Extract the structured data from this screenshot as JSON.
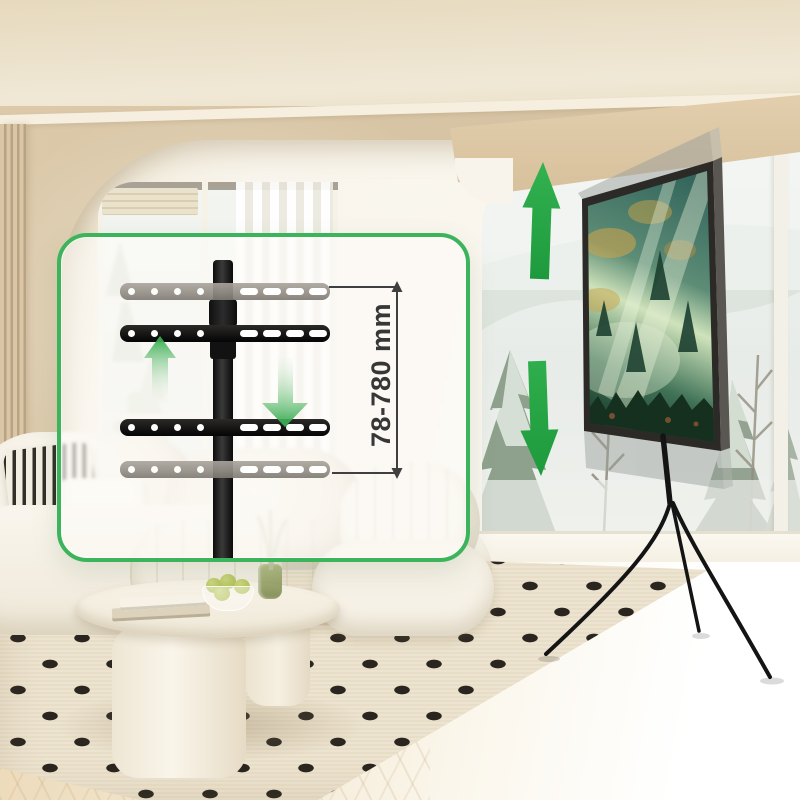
{
  "annotation": {
    "height_range_label": "78-780 mm"
  },
  "inset_panel": {
    "border_color": "#3CB45C",
    "background": "rgba(253,252,248,0.62)",
    "bracket_bars": {
      "count": 4,
      "solid_color": "#1B1918",
      "ghost_color": "#9B968E",
      "round_holes_per_bar": 4,
      "slots_per_bar": 4
    },
    "arrows": [
      "up-arrow",
      "down-arrow"
    ]
  },
  "tv_area": {
    "arrows": [
      "up-arrow",
      "down-arrow"
    ],
    "arrow_color": "#2AA747",
    "screen_theme": "misty-forest",
    "stand_color": "#151515",
    "ghost_positions": [
      "raised",
      "lowered"
    ]
  },
  "palette": {
    "accent_green": "#3CB45C",
    "dimension_line": "#3F3F3F",
    "label_text": "#373737",
    "wall": "#D7C4A6",
    "rug_dash": "#27231E"
  }
}
